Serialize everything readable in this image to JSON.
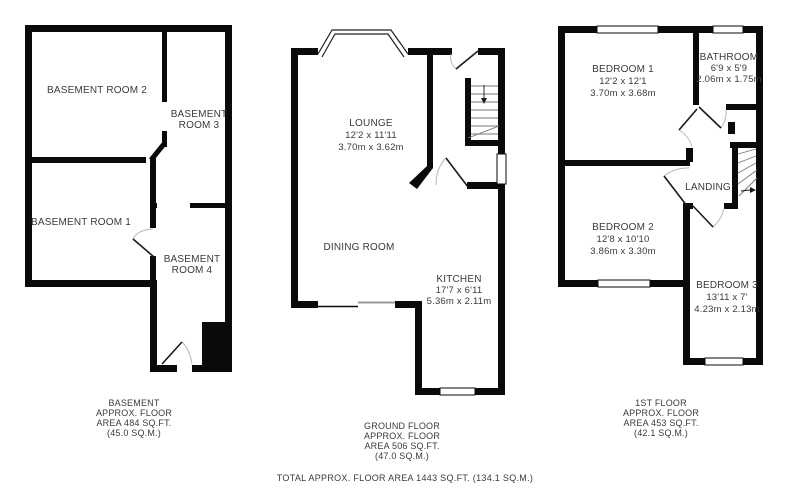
{
  "colors": {
    "wall": "#0a0a0a",
    "text": "#3a3a3a",
    "background": "#ffffff",
    "door_arc": "#b8b8b8"
  },
  "floors": [
    {
      "id": "basement",
      "rooms": [
        {
          "name": "basement-room-2",
          "lines": [
            "BASEMENT ROOM 2"
          ]
        },
        {
          "name": "basement-room-3",
          "lines": [
            "BASEMENT",
            "ROOM 3"
          ]
        },
        {
          "name": "basement-room-1",
          "lines": [
            "BASEMENT ROOM 1"
          ]
        },
        {
          "name": "basement-room-4",
          "lines": [
            "BASEMENT",
            "ROOM 4"
          ]
        }
      ],
      "footer": [
        "BASEMENT",
        "APPROX. FLOOR",
        "AREA 484 SQ.FT.",
        "(45.0 SQ.M.)"
      ]
    },
    {
      "id": "ground-floor",
      "rooms": [
        {
          "name": "lounge",
          "lines": [
            "LOUNGE",
            "12'2 x 11'11",
            "3.70m x 3.62m"
          ]
        },
        {
          "name": "dining-room",
          "lines": [
            "DINING ROOM"
          ]
        },
        {
          "name": "kitchen",
          "lines": [
            "KITCHEN",
            "17'7 x 6'11",
            "5.36m x 2.11m"
          ]
        }
      ],
      "footer": [
        "GROUND FLOOR",
        "APPROX. FLOOR",
        "AREA 506 SQ.FT.",
        "(47.0 SQ.M.)"
      ]
    },
    {
      "id": "first-floor",
      "rooms": [
        {
          "name": "bedroom-1",
          "lines": [
            "BEDROOM 1",
            "12'2 x 12'1",
            "3.70m x 3.68m"
          ]
        },
        {
          "name": "bathroom",
          "lines": [
            "BATHROOM",
            "6'9 x 5'9",
            "2.06m x 1.75m"
          ]
        },
        {
          "name": "landing",
          "lines": [
            "LANDING"
          ]
        },
        {
          "name": "bedroom-2",
          "lines": [
            "BEDROOM 2",
            "12'8 x 10'10",
            "3.86m x 3.30m"
          ]
        },
        {
          "name": "bedroom-3",
          "lines": [
            "BEDROOM 3",
            "13'11 x 7'",
            "4.23m x 2.13m"
          ]
        }
      ],
      "footer": [
        "1ST FLOOR",
        "APPROX. FLOOR",
        "AREA 453 SQ.FT.",
        "(42.1 SQ.M.)"
      ]
    }
  ],
  "total_label": "TOTAL APPROX. FLOOR AREA 1443 SQ.FT. (134.1 SQ.M.)"
}
